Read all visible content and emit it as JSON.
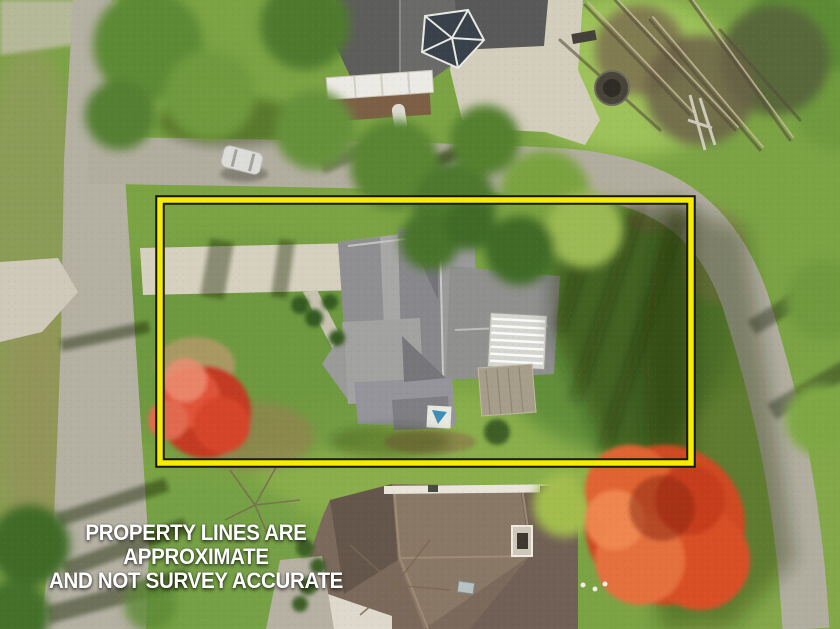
{
  "disclaimer": {
    "line1": "PROPERTY LINES ARE APPROXIMATE",
    "line2": "AND NOT SURVEY ACCURATE",
    "text_color": "#ffffff"
  },
  "boundary": {
    "shape": "rectangle",
    "stroke_color": "#f6ec00",
    "outline_color": "#161608"
  },
  "palette": {
    "grass_base": "#7ba344",
    "grass_sunlit": "#9ec25a",
    "grass_shadow": "#5c8a38",
    "road_asphalt": "#b4b0a2",
    "concrete_driveway": "#d3cdbc",
    "main_roof_gray": "#9a9a9c",
    "neighbor_roof_brown": "#7b6a5c",
    "neighbor_roof_dark_gray": "#6a6a68",
    "autumn_red_tree": "#cf4a22",
    "crimson_tree": "#c23b24"
  },
  "scene": {
    "type": "aerial-drone-photograph",
    "season_cues": "autumn foliage",
    "elements": [
      "street-left",
      "street-top-curving-right",
      "main-house-gray-roof",
      "property-driveway",
      "front-walkway",
      "striped-awning",
      "rear-deck",
      "red-maple-front-yard",
      "large-orange-maple-rear",
      "neighbor-house-top",
      "neighbor-house-bottom",
      "parked-car",
      "fire-pit",
      "gazebo",
      "white-canopy",
      "backyard-lawn"
    ]
  }
}
